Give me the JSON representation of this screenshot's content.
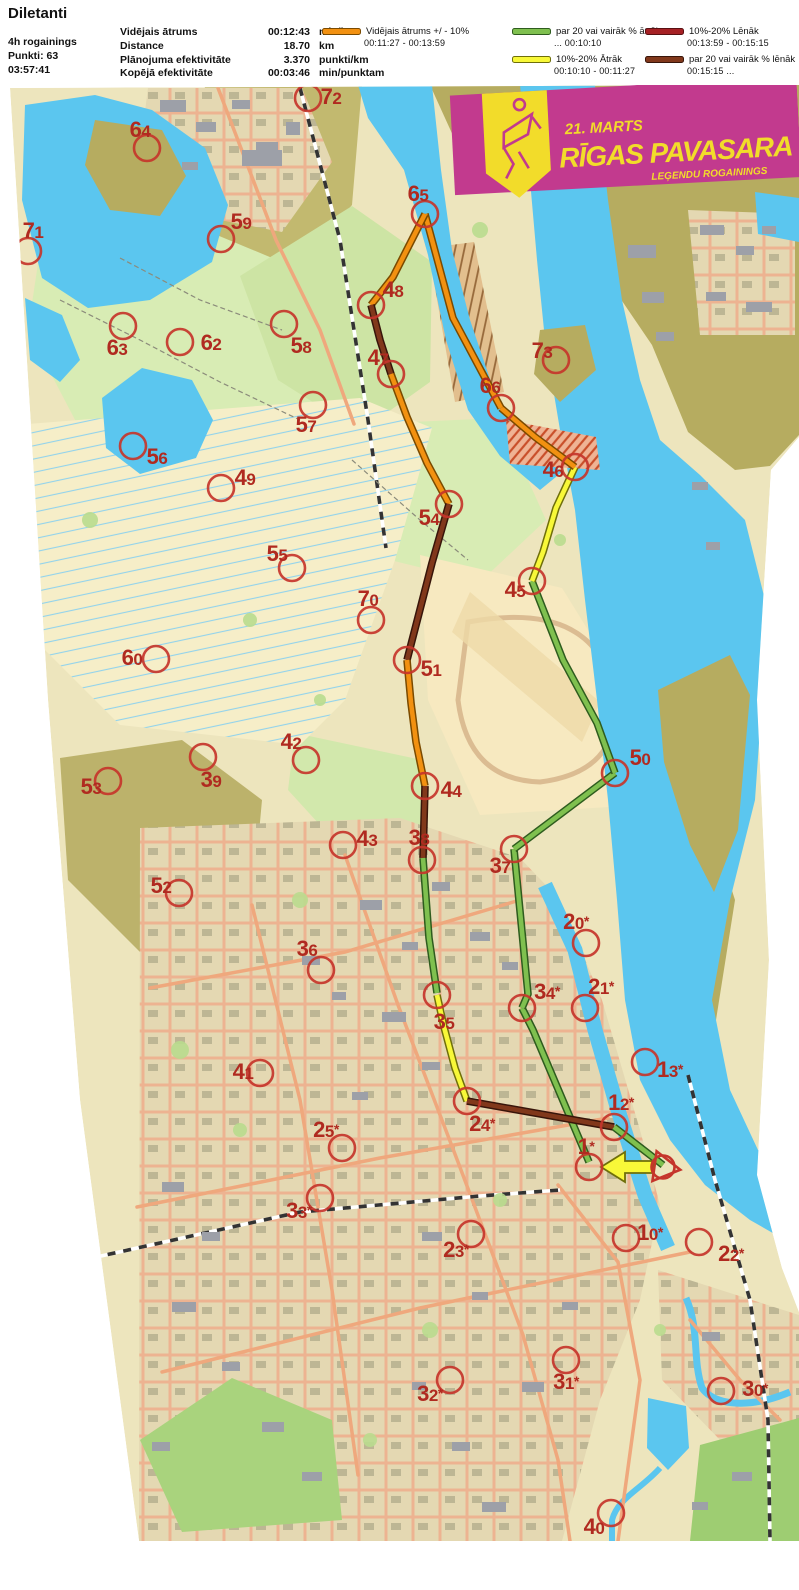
{
  "header": {
    "title": "Diletanti",
    "left": [
      "4h rogainings",
      "Punkti: 63",
      "03:57:41"
    ],
    "stats": [
      {
        "label": "Vidējais ātrums",
        "value": "00:12:43",
        "unit": "min/km"
      },
      {
        "label": "Distance",
        "value": "18.70",
        "unit": "km"
      },
      {
        "label": "Plānojuma efektivitāte",
        "value": "3.370",
        "unit": "punkti/km"
      },
      {
        "label": "Kopējā efektivitāte",
        "value": "00:03:46",
        "unit": "min/punktam"
      }
    ]
  },
  "legend": {
    "columns": [
      [
        {
          "speed": "avg",
          "label": "Vidējais ātrums +/ - 10%",
          "range": "00:11:27   -   00:13:59"
        }
      ],
      [
        {
          "speed": "fast20",
          "label": "par 20 vai vairāk % ātrāk",
          "range": "...   00:10:10"
        },
        {
          "speed": "fast10",
          "label": "10%-20% Ātrāk",
          "range": "00:10:10   -   00:11:27"
        }
      ],
      [
        {
          "speed": "slow10",
          "label": "10%-20% Lēnāk",
          "range": "00:13:59   -   00:15:15"
        },
        {
          "speed": "slow20",
          "label": "par 20 vai vairāk % lēnāk",
          "range": "00:15:15   ..."
        }
      ]
    ]
  },
  "banner": {
    "line1": "21. MARTS",
    "line2": "RĪGAS PAVASARA",
    "line3": "LEĢENDU ROGAININGS",
    "bg": "#C23A8E",
    "accent": "#F2DC2A"
  },
  "map": {
    "circle_color": "#C5352B",
    "label_color": "#B02A20",
    "route": {
      "styles": {
        "avg": {
          "main": "#F29111",
          "edge": "#7A4A00"
        },
        "fast20": {
          "main": "#7FC04F",
          "edge": "#2E5C1E"
        },
        "fast10": {
          "main": "#F8F838",
          "edge": "#6F6F0A"
        },
        "slow10": {
          "main": "#A62125",
          "edge": "#591012"
        },
        "slow20": {
          "main": "#81381B",
          "edge": "#38150A"
        }
      },
      "sequence": [
        "start",
        "1*",
        "34*",
        "37",
        "50",
        "45",
        "46",
        "66",
        "65",
        "48",
        "47",
        "54",
        "51",
        "44",
        "38",
        "35",
        "24*",
        "12*",
        "finish"
      ],
      "legs": [
        {
          "from": "1*",
          "to": "34*",
          "speed": "fast20",
          "points": [
            [
              589,
              1162
            ],
            [
              533,
              1030
            ],
            [
              522,
              1008
            ]
          ]
        },
        {
          "from": "34*",
          "to": "37",
          "speed": "fast20",
          "points": [
            [
              522,
              1008
            ],
            [
              528,
              994
            ],
            [
              514,
              849
            ]
          ]
        },
        {
          "from": "37",
          "to": "50",
          "speed": "fast20",
          "points": [
            [
              514,
              849
            ],
            [
              615,
              773
            ]
          ]
        },
        {
          "from": "50",
          "to": "45",
          "speed": "fast20",
          "points": [
            [
              615,
              773
            ],
            [
              597,
              723
            ],
            [
              563,
              660
            ],
            [
              532,
              581
            ]
          ]
        },
        {
          "from": "45",
          "to": "46",
          "speed": "fast10",
          "points": [
            [
              532,
              581
            ],
            [
              543,
              552
            ],
            [
              556,
              508
            ],
            [
              575,
              467
            ]
          ]
        },
        {
          "from": "46",
          "to": "66",
          "speed": "avg",
          "points": [
            [
              575,
              467
            ],
            [
              535,
              437
            ],
            [
              501,
              408
            ]
          ]
        },
        {
          "from": "66",
          "to": "65",
          "speed": "avg",
          "points": [
            [
              501,
              408
            ],
            [
              453,
              318
            ],
            [
              425,
              214
            ]
          ]
        },
        {
          "from": "65",
          "to": "48",
          "speed": "avg",
          "points": [
            [
              425,
              214
            ],
            [
              393,
              277
            ],
            [
              371,
              305
            ]
          ]
        },
        {
          "from": "48",
          "to": "47",
          "speed": "slow20",
          "points": [
            [
              371,
              305
            ],
            [
              380,
              340
            ],
            [
              391,
              374
            ]
          ]
        },
        {
          "from": "47",
          "to": "54",
          "speed": "avg",
          "points": [
            [
              391,
              374
            ],
            [
              407,
              417
            ],
            [
              427,
              463
            ],
            [
              449,
              504
            ]
          ]
        },
        {
          "from": "54",
          "to": "51",
          "speed": "slow20",
          "points": [
            [
              449,
              504
            ],
            [
              432,
              563
            ],
            [
              407,
              660
            ]
          ]
        },
        {
          "from": "51",
          "to": "44",
          "speed": "avg",
          "points": [
            [
              407,
              660
            ],
            [
              411,
              703
            ],
            [
              416,
              742
            ],
            [
              425,
              786
            ]
          ]
        },
        {
          "from": "44",
          "to": "38",
          "speed": "slow20",
          "points": [
            [
              425,
              786
            ],
            [
              423,
              858
            ]
          ]
        },
        {
          "from": "38",
          "to": "35",
          "speed": "fast20",
          "points": [
            [
              423,
              858
            ],
            [
              429,
              938
            ],
            [
              437,
              993
            ]
          ]
        },
        {
          "from": "35",
          "to": "24*",
          "speed": "fast10",
          "points": [
            [
              437,
              995
            ],
            [
              444,
              1027
            ],
            [
              455,
              1068
            ],
            [
              467,
              1101
            ]
          ]
        },
        {
          "from": "24*",
          "to": "12*",
          "speed": "slow20",
          "points": [
            [
              467,
              1101
            ],
            [
              614,
              1127
            ]
          ]
        },
        {
          "from": "12*",
          "to": "finish",
          "speed": "fast20",
          "points": [
            [
              614,
              1127
            ],
            [
              663,
              1165
            ]
          ]
        }
      ],
      "start_arrow": {
        "tip": [
          601,
          1167
        ],
        "tail": [
          653,
          1167
        ],
        "speed": "fast10"
      }
    },
    "start": {
      "x": 663,
      "y": 1167
    },
    "controls": [
      {
        "id": "72",
        "cx": 308,
        "cy": 98,
        "lx": 331,
        "ly": 97
      },
      {
        "id": "64",
        "cx": 147,
        "cy": 148,
        "lx": 140,
        "ly": 130
      },
      {
        "id": "71",
        "cx": 28,
        "cy": 251,
        "lx": 33,
        "ly": 231
      },
      {
        "id": "59",
        "cx": 221,
        "cy": 239,
        "lx": 241,
        "ly": 222
      },
      {
        "id": "63",
        "cx": 123,
        "cy": 326,
        "lx": 117,
        "ly": 348
      },
      {
        "id": "62",
        "cx": 180,
        "cy": 342,
        "lx": 211,
        "ly": 343
      },
      {
        "id": "58",
        "cx": 284,
        "cy": 324,
        "lx": 301,
        "ly": 346
      },
      {
        "id": "65",
        "cx": 425,
        "cy": 214,
        "lx": 418,
        "ly": 194
      },
      {
        "id": "48",
        "cx": 371,
        "cy": 305,
        "lx": 393,
        "ly": 290
      },
      {
        "id": "47",
        "cx": 391,
        "cy": 374,
        "lx": 378,
        "ly": 358
      },
      {
        "id": "73",
        "cx": 556,
        "cy": 360,
        "lx": 542,
        "ly": 351
      },
      {
        "id": "66",
        "cx": 501,
        "cy": 408,
        "lx": 490,
        "ly": 386
      },
      {
        "id": "57",
        "cx": 313,
        "cy": 405,
        "lx": 306,
        "ly": 425
      },
      {
        "id": "56",
        "cx": 133,
        "cy": 446,
        "lx": 157,
        "ly": 457
      },
      {
        "id": "49",
        "cx": 221,
        "cy": 488,
        "lx": 245,
        "ly": 478
      },
      {
        "id": "46",
        "cx": 575,
        "cy": 467,
        "lx": 553,
        "ly": 470
      },
      {
        "id": "54",
        "cx": 449,
        "cy": 504,
        "lx": 429,
        "ly": 518
      },
      {
        "id": "55",
        "cx": 292,
        "cy": 568,
        "lx": 277,
        "ly": 554
      },
      {
        "id": "45",
        "cx": 532,
        "cy": 581,
        "lx": 515,
        "ly": 590
      },
      {
        "id": "70",
        "cx": 371,
        "cy": 620,
        "lx": 368,
        "ly": 599
      },
      {
        "id": "60",
        "cx": 156,
        "cy": 659,
        "lx": 132,
        "ly": 658
      },
      {
        "id": "51",
        "cx": 407,
        "cy": 660,
        "lx": 431,
        "ly": 669
      },
      {
        "id": "50",
        "cx": 615,
        "cy": 773,
        "lx": 640,
        "ly": 758
      },
      {
        "id": "42",
        "cx": 306,
        "cy": 760,
        "lx": 291,
        "ly": 742
      },
      {
        "id": "39",
        "cx": 203,
        "cy": 757,
        "lx": 211,
        "ly": 780
      },
      {
        "id": "53",
        "cx": 108,
        "cy": 781,
        "lx": 91,
        "ly": 787
      },
      {
        "id": "44",
        "cx": 425,
        "cy": 786,
        "lx": 451,
        "ly": 790
      },
      {
        "id": "43",
        "cx": 343,
        "cy": 845,
        "lx": 367,
        "ly": 839
      },
      {
        "id": "38",
        "cx": 422,
        "cy": 860,
        "lx": 419,
        "ly": 838
      },
      {
        "id": "37",
        "cx": 514,
        "cy": 849,
        "lx": 500,
        "ly": 866
      },
      {
        "id": "52",
        "cx": 179,
        "cy": 893,
        "lx": 161,
        "ly": 886
      },
      {
        "id": "36",
        "cx": 321,
        "cy": 970,
        "lx": 307,
        "ly": 949
      },
      {
        "id": "20*",
        "cx": 586,
        "cy": 943,
        "lx": 576,
        "ly": 922
      },
      {
        "id": "34*",
        "cx": 522,
        "cy": 1008,
        "lx": 547,
        "ly": 992
      },
      {
        "id": "21*",
        "cx": 585,
        "cy": 1008,
        "lx": 601,
        "ly": 987
      },
      {
        "id": "35",
        "cx": 437,
        "cy": 995,
        "lx": 444,
        "ly": 1022
      },
      {
        "id": "13*",
        "cx": 645,
        "cy": 1062,
        "lx": 670,
        "ly": 1070
      },
      {
        "id": "41",
        "cx": 260,
        "cy": 1073,
        "lx": 243,
        "ly": 1072
      },
      {
        "id": "24*",
        "cx": 467,
        "cy": 1101,
        "lx": 482,
        "ly": 1124
      },
      {
        "id": "12*",
        "cx": 614,
        "cy": 1127,
        "lx": 621,
        "ly": 1103
      },
      {
        "id": "25*",
        "cx": 342,
        "cy": 1148,
        "lx": 326,
        "ly": 1130
      },
      {
        "id": "1*",
        "cx": 589,
        "cy": 1167,
        "lx": 586,
        "ly": 1147
      },
      {
        "id": "33*",
        "cx": 320,
        "cy": 1198,
        "lx": 299,
        "ly": 1211
      },
      {
        "id": "23*",
        "cx": 471,
        "cy": 1234,
        "lx": 456,
        "ly": 1250
      },
      {
        "id": "10*",
        "cx": 626,
        "cy": 1238,
        "lx": 650,
        "ly": 1233
      },
      {
        "id": "22*",
        "cx": 699,
        "cy": 1242,
        "lx": 731,
        "ly": 1254
      },
      {
        "id": "32*",
        "cx": 450,
        "cy": 1380,
        "lx": 430,
        "ly": 1394
      },
      {
        "id": "31*",
        "cx": 566,
        "cy": 1360,
        "lx": 566,
        "ly": 1382
      },
      {
        "id": "30*",
        "cx": 721,
        "cy": 1391,
        "lx": 755,
        "ly": 1389
      },
      {
        "id": "40",
        "cx": 611,
        "cy": 1513,
        "lx": 594,
        "ly": 1527
      }
    ]
  }
}
